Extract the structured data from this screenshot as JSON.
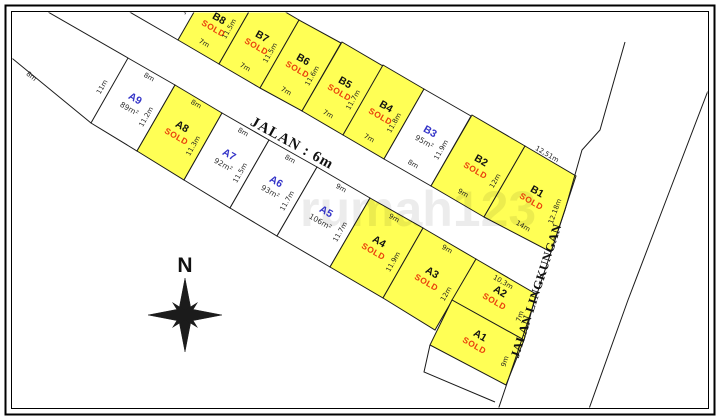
{
  "roads": {
    "main_label": "JALAN : 6m",
    "side_label": "JALAN LINGKUNGAN"
  },
  "compass_label": "N",
  "watermark": "rumah123",
  "colors": {
    "sold_fill": "#FFFF55",
    "available_fill": "#FFFFFF",
    "sold_text": "#E93E0B",
    "name_color": "#3434C8",
    "sold_name_color": "#111111",
    "line_color": "#1A1A1A",
    "frame_color": "#000000"
  },
  "plots": [
    {
      "id": "B8",
      "sold": true,
      "badge": "SOLD"
    },
    {
      "id": "B7",
      "sold": true,
      "badge": "SOLD"
    },
    {
      "id": "B6",
      "sold": true,
      "badge": "SOLD"
    },
    {
      "id": "B5",
      "sold": true,
      "badge": "SOLD"
    },
    {
      "id": "B4",
      "sold": true,
      "badge": "SOLD"
    },
    {
      "id": "B3",
      "sold": false,
      "badge": "95m²"
    },
    {
      "id": "B2",
      "sold": true,
      "badge": "SOLD"
    },
    {
      "id": "B1",
      "sold": true,
      "badge": "SOLD"
    },
    {
      "id": "A9",
      "sold": false,
      "badge": "89m²"
    },
    {
      "id": "A8",
      "sold": true,
      "badge": "SOLD"
    },
    {
      "id": "A7",
      "sold": false,
      "badge": "92m²"
    },
    {
      "id": "A6",
      "sold": false,
      "badge": "93m²"
    },
    {
      "id": "A5",
      "sold": false,
      "badge": "106m²"
    },
    {
      "id": "A4",
      "sold": true,
      "badge": "SOLD"
    },
    {
      "id": "A3",
      "sold": true,
      "badge": "SOLD"
    },
    {
      "id": "A2",
      "sold": true,
      "badge": "SOLD"
    },
    {
      "id": "A1",
      "sold": true,
      "badge": "SOLD"
    }
  ],
  "dimensions": {
    "B8_left": "11.5m",
    "B8_front": "7m",
    "B8_B7": "11.5m",
    "B7_front": "7m",
    "B7_B6": "11.5m",
    "B6_front": "7m",
    "B6_B5": "11.6m",
    "B5_front": "7m",
    "B5_B4": "11.7m",
    "B4_front": "7m",
    "B4_B3": "11.8m",
    "B3_front": "8m",
    "B3_B2": "11.9m",
    "B2_front": "9m",
    "B2_B1": "12m",
    "B1_top": "12,51m",
    "B1_front": "14m",
    "B1_right": "12.18m",
    "NW_boundary": "8m",
    "A9_left": "11m",
    "A9_top": "8m",
    "A9_A8": "11.2m",
    "A8_top": "8m",
    "A8_A7": "11.3m",
    "A7_top": "8m",
    "A7_A6": "11.5m",
    "A6_top": "8m",
    "A6_A5": "11.7m",
    "A5_top": "9m",
    "A5_A4": "11.7m",
    "A4_top": "9m",
    "A4_A3": "11.9m",
    "A3_top": "9m",
    "A3_A2": "12m",
    "A2_top": "10,3m",
    "A2_right": "7m",
    "A1_right": "9m"
  }
}
